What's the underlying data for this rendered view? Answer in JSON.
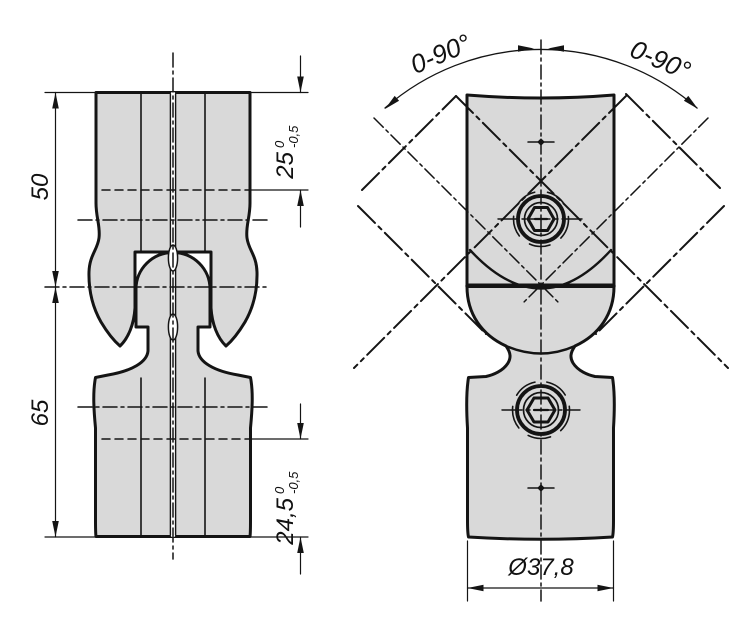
{
  "drawing": {
    "title": "swivel-tube-clamp-joint-two-view-technical-drawing",
    "colors": {
      "part_fill": "#d9d9d9",
      "line": "#141414",
      "background": "#ffffff"
    },
    "left_view": {
      "dim_overall_upper": "50",
      "dim_overall_lower": "65",
      "dim_clamp_upper": {
        "value": "25",
        "tol_upper": "0",
        "tol_lower": "-0,5"
      },
      "dim_clamp_lower": {
        "value": "24,5",
        "tol_upper": "0",
        "tol_lower": "-0,5"
      }
    },
    "right_view": {
      "angle_left": "0-90°",
      "angle_right": "0-90°",
      "dim_diameter": "Ø37,8"
    }
  }
}
